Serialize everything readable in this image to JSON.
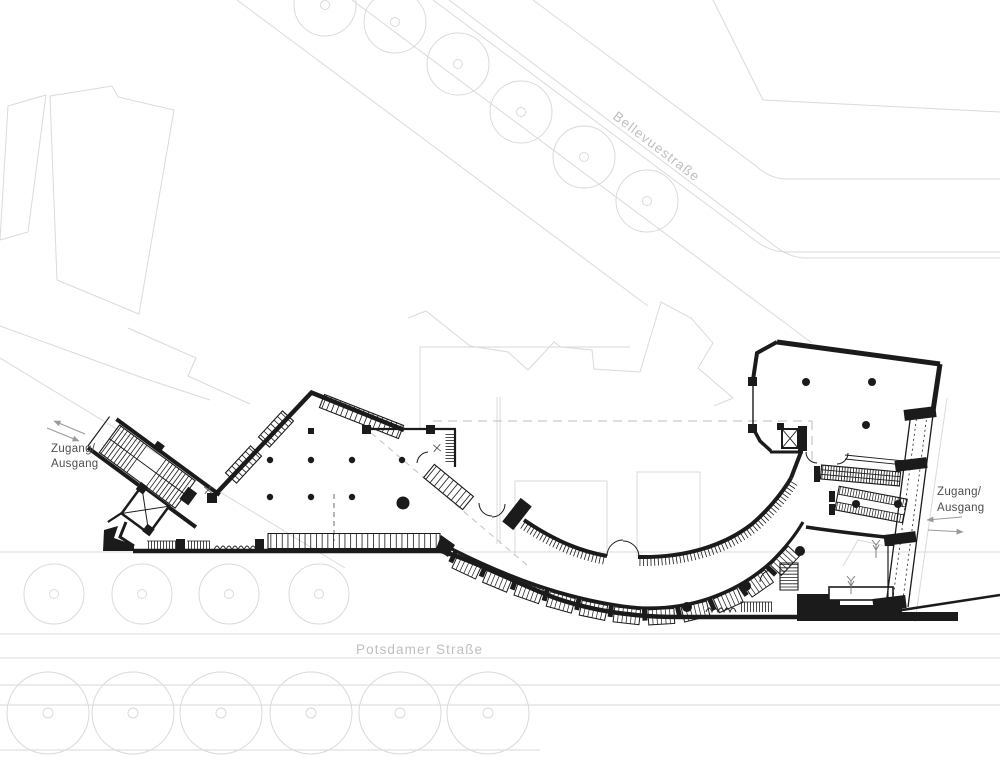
{
  "canvas": {
    "width": 1000,
    "height": 757,
    "background": "#ffffff"
  },
  "title": "Site floor plan",
  "colors": {
    "plan_black": "#1b1b1b",
    "faint_line": "#dadada",
    "faint_dash": "#c9c9c9",
    "street_text": "#c0c0c0",
    "label_text": "#4d4d4d",
    "arrow_gray": "#9a9a9a"
  },
  "streets": {
    "bellevuestrasse": "Bellevuestraße",
    "potsdamer_strasse": "Potsdamer Straße"
  },
  "entrances": {
    "left": {
      "line1": "Zugang/",
      "line2": "Ausgang"
    },
    "right": {
      "line1": "Zugang/",
      "line2": "Ausgang"
    }
  },
  "icons": {
    "elevator": "elevator-shaft-x-icon",
    "stairs": "stair-hatch-icon",
    "escalator": "escalator-hatch-icon",
    "tree": "tree-circle-icon",
    "door": "door-swing-icon",
    "arrow": "direction-arrow-icon"
  }
}
